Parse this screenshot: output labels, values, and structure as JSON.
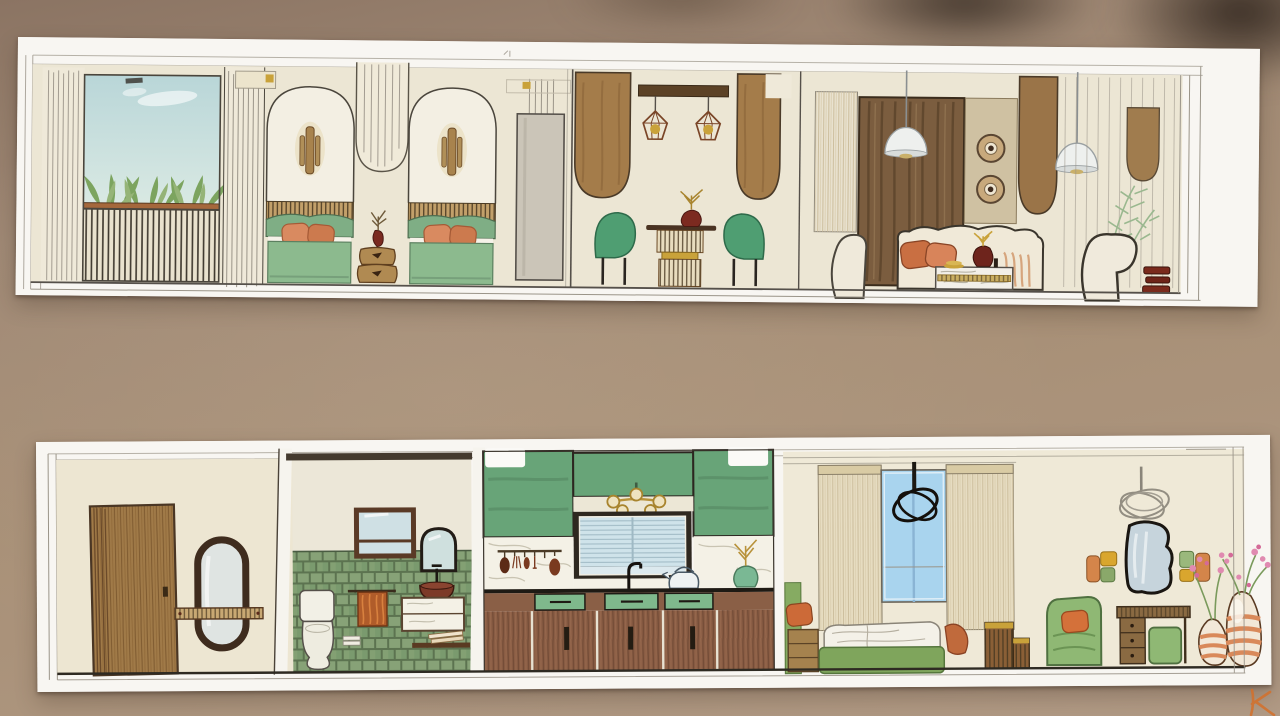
{
  "scene": {
    "kind": "photograph",
    "subject": "two hand-painted interior elevation boards on a table",
    "strips": [
      {
        "name": "top-elevation-board",
        "rooms": [
          "balcony-planter",
          "twin-bedroom",
          "wardrobe",
          "dining-area",
          "living-room",
          "reading-corner"
        ]
      },
      {
        "name": "bottom-elevation-board",
        "rooms": [
          "entry-hall",
          "bathroom",
          "kitchen",
          "bedroom",
          "vanity-living-corner"
        ]
      }
    ]
  },
  "palette": {
    "table-bg": "#a48c78",
    "paper": "#f8f6f2",
    "wall-cream": "#ece6d4",
    "wall-cream2": "#efe9d7",
    "sky-blue": "#c6dfdf",
    "leaf-green": "#7ca45f",
    "leaf-green2": "#95b477",
    "planter-brown": "#a5683c",
    "bed-green": "#8cba8e",
    "headboard-green": "#7fae85",
    "chair-green": "#4f9e72",
    "armchair-green": "#8fb874",
    "kitchen-green": "#68a478",
    "drawer-green": "#7fb88c",
    "tile-green": "#7e9a70",
    "bedframe-green": "#7fa55c",
    "vase-green": "#7ab894",
    "wood-light": "#b08a52",
    "wood-mid": "#a47c4a",
    "wood-dark": "#7b5d3f",
    "beam-brown": "#5c4226",
    "cabinet-brown": "#8a5d44",
    "door-brown": "#a07a48",
    "frame-brown": "#4a3526",
    "rust": "#c96f42",
    "pillow-orange": "#d98a60",
    "terracotta": "#d4854a",
    "towel-orange": "#b05c2a",
    "dark-red": "#7a2a20",
    "gold": "#c9a23a",
    "window-blue": "#a9d4ee",
    "blind-blue": "#cfe3ea",
    "mirror-glass": "#cfe0e4",
    "curtain-tan": "#e7ddc2",
    "tan-panel": "#cfc1a2",
    "gray-panel": "#cbc5b8",
    "marble": "#f4f1e6",
    "pencil": "#9a9488",
    "outline": "#4a453c",
    "floor-line": "#2e2a22",
    "pink": "#e08ab0",
    "sig-orange": "#d4702a"
  }
}
